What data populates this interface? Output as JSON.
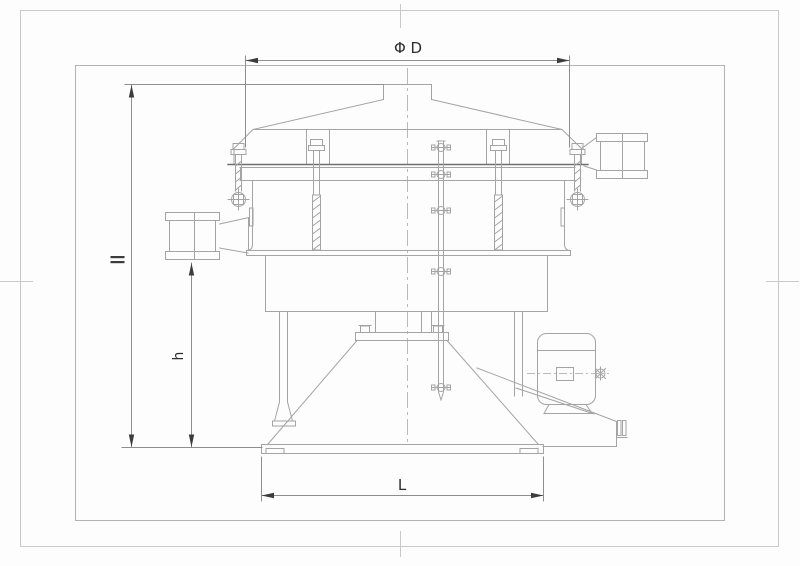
{
  "labels": {
    "diameter": "Φ D",
    "height": "h",
    "length": "L"
  },
  "colors": {
    "background": "#fdfdfd",
    "frame_outer": "#c9c9c9",
    "frame_inner": "#b2b2b2",
    "line": "#a4a4a4",
    "line_dark": "#6f6f6f",
    "dim_line": "#8e8e8e",
    "centerline": "#b9b9b9",
    "arrow": "#3c3c3c",
    "label_text": "#2d2d2d"
  }
}
